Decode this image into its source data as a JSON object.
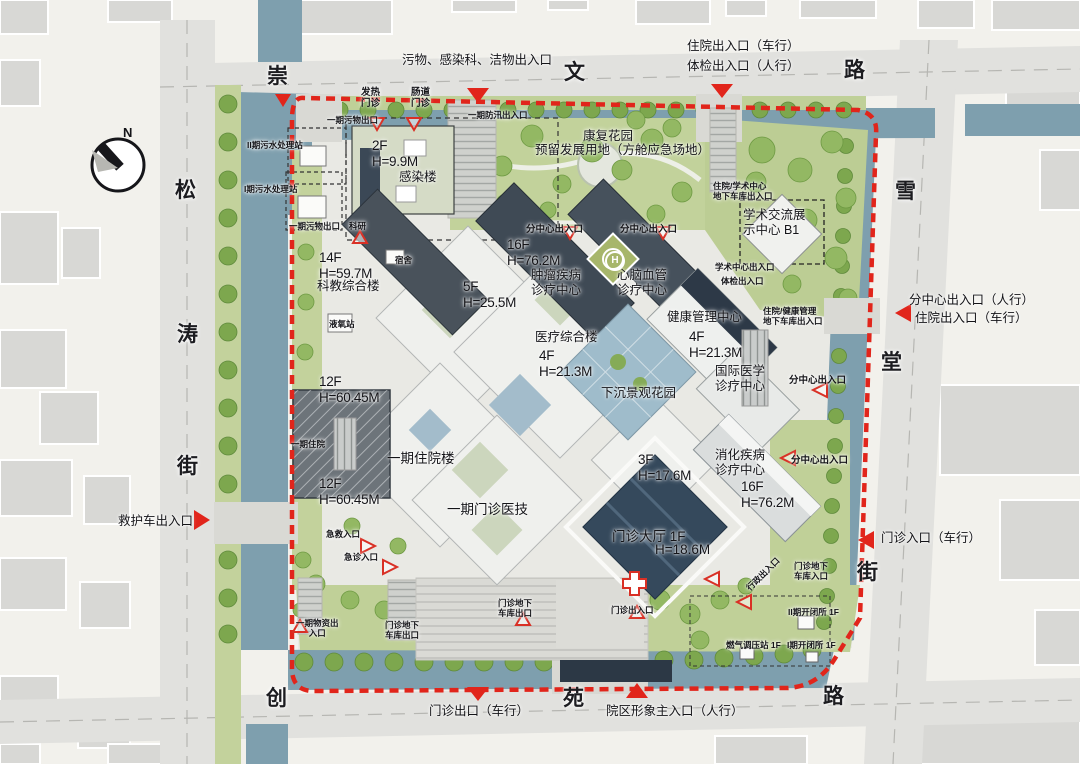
{
  "compass": {
    "north": "N"
  },
  "streets": {
    "top": [
      "崇",
      "文",
      "路"
    ],
    "left": [
      "松",
      "涛",
      "街"
    ],
    "right": [
      "雪",
      "堂",
      "街"
    ],
    "bottom": [
      "创",
      "苑",
      "路"
    ]
  },
  "perimeter": {
    "ambulance_exit": "救护车出入口",
    "waste_infection_clean": "污物、感染科、洁物出入口",
    "inpatient_vehicle_top": "住院出入口（车行）",
    "exam_pedestrian_top": "体检出入口（人行）",
    "subcenter_pedestrian_right": "分中心出入口（人行）",
    "inpatient_vehicle_right": "住院出入口（车行）",
    "outpatient_in_vehicle": "门诊入口（车行）",
    "outpatient_out_vehicle": "门诊出口（车行）",
    "main_image_entrance": "院区形象主入口（人行）"
  },
  "site": {
    "helipad": "H",
    "fever_clinic": "发热\n门诊",
    "intestinal_clinic": "肠道\n门诊",
    "phase1_waste_exit_a": "一期污物出口",
    "phase1_flood_access": "一期防汛出入口",
    "sewage_station_2": "II期污水处理站",
    "sewage_station_1": "I期污水处理站",
    "infection_fh": "2F\nH=9.9M",
    "infection_building": "感染楼",
    "rehab_garden": "康复花园",
    "reserved_land": "预留发展用地（方舱应急场地）",
    "inpatient_academic_garage": "住院/学术中心\n地下车库出入口",
    "academic_center": "学术交流展\n示中心 B1",
    "phase1_waste_exit_b": "一期污物出口",
    "research": "科研",
    "subcenter_entrance_a": "分中心出入口",
    "subcenter_entrance_b": "分中心出入口",
    "tumor_fh": "16F\nH=76.2M",
    "tumor_center": "肿瘤疾病\n诊疗中心",
    "cardio_center": "心脑血管\n诊疗中心",
    "academic_entrance": "学术中心出入口",
    "exam_entrance": "体检出入口",
    "keyan_fh": "14F\nH=59.7M",
    "keyan_building": "科教综合楼",
    "dormitory": "宿舍",
    "podium_fh": "5F\nH=25.5M",
    "lox_station": "液氧站",
    "medical_complex": "医疗综合楼",
    "medical_complex_fh": "4F\nH=21.3M",
    "health_center": "健康管理中心",
    "health_center_fh": "4F\nH=21.3M",
    "inpatient_health_garage": "住院/健康管理\n地下车库出入口",
    "sunken_garden": "下沉景观花园",
    "intl_center": "国际医学\n诊疗中心",
    "subcenter_entrance_c": "分中心出入口",
    "inpatient_fh_a": "12F\nH=60.45M",
    "phase1_inpatient_entrance": "一期住院",
    "phase1_inpatient_building": "一期住院楼",
    "inpatient_fh_b": "12F\nH=60.45M",
    "phase1_outpatient_building": "一期门诊医技",
    "hall_podium_fh": "3F\nH=17.6M",
    "digest_center": "消化疾病\n诊疗中心",
    "subcenter_entrance_d": "分中心出入口",
    "digest_fh": "16F\nH=76.2M",
    "rescue_entrance": "急救入口",
    "emergency_entrance": "急诊入口",
    "outpatient_hall": "门诊大厅 1F",
    "outpatient_hall_h": "H=18.6M",
    "admin_entrance": "行政出入口",
    "outpatient_garage_in": "门诊地下\n车库入口",
    "outpatient_entrance": "门诊出入口",
    "switch_station_2": "II期开闭所 1F",
    "gas_station": "燃气调压站 1F",
    "switch_station_1": "I期开闭所 1F",
    "phase1_material_entrance": "一期物资出\n入口",
    "outpatient_garage_out_a": "门诊地下\n车库出口",
    "outpatient_garage_out_b": "门诊地下\n车库出口"
  },
  "colors": {
    "boundary_red": "#e1251b",
    "water": "#7e9fae",
    "lawn": "#bfd098",
    "tree_green": "#7da74e",
    "road_gray": "#e0e0dd",
    "dark_glass": "#35495c",
    "building_white": "#f0f1ee",
    "paper": "#f2f1ec"
  }
}
